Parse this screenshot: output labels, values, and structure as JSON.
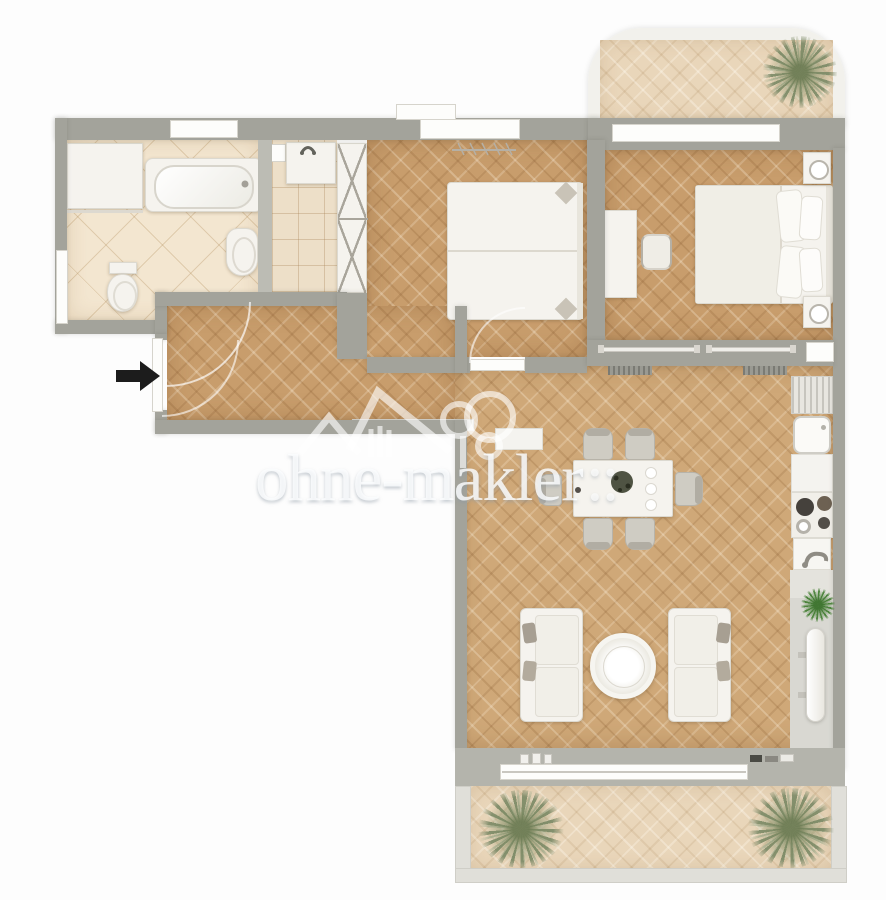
{
  "watermark": {
    "text": "ohne-makler",
    "suffix": "::",
    "logo": "ohne-makler-house-tree-logo"
  },
  "colors": {
    "wall": "#a3a39b",
    "wall_light": "#bcbcb4",
    "wood_floor": "#c89d6c",
    "pale_balcony_wood": "#e9d6ba",
    "bathroom_tile": "#f3e6d0",
    "furniture_white": "#f5f3ee",
    "plant_sage": "#828e6c",
    "plant_green": "#4b833a",
    "entrance_arrow": "#1c1c1c",
    "watermark_white": "rgba(253,254,255,0.82)"
  }
}
